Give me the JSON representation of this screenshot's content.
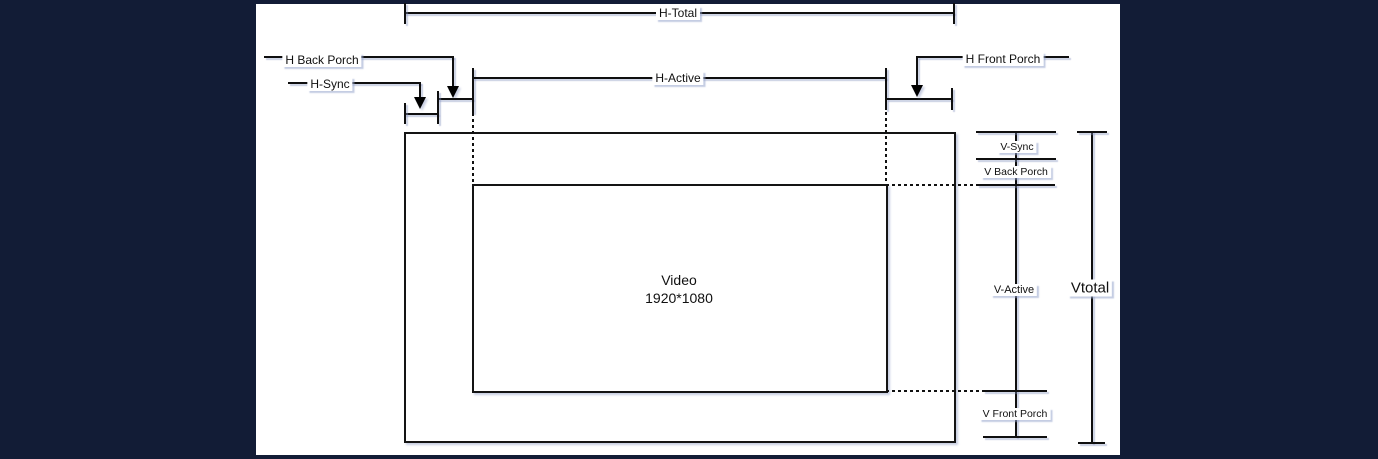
{
  "diagram": {
    "title_hint": "Video timing diagram",
    "labels": {
      "h_total": "H-Total",
      "h_back_porch": "H Back Porch",
      "h_sync": "H-Sync",
      "h_active": "H-Active",
      "h_front_porch": "H Front Porch",
      "v_sync": "V-Sync",
      "v_back_porch": "V Back Porch",
      "v_active": "V-Active",
      "v_front_porch": "V Front Porch",
      "v_total": "Vtotal",
      "video_title": "Video",
      "video_resolution": "1920*1080"
    },
    "colors": {
      "page_background": "#121c36",
      "canvas_background": "#ffffff",
      "line": "#000000",
      "label_shadow": "#96a4cc"
    }
  }
}
